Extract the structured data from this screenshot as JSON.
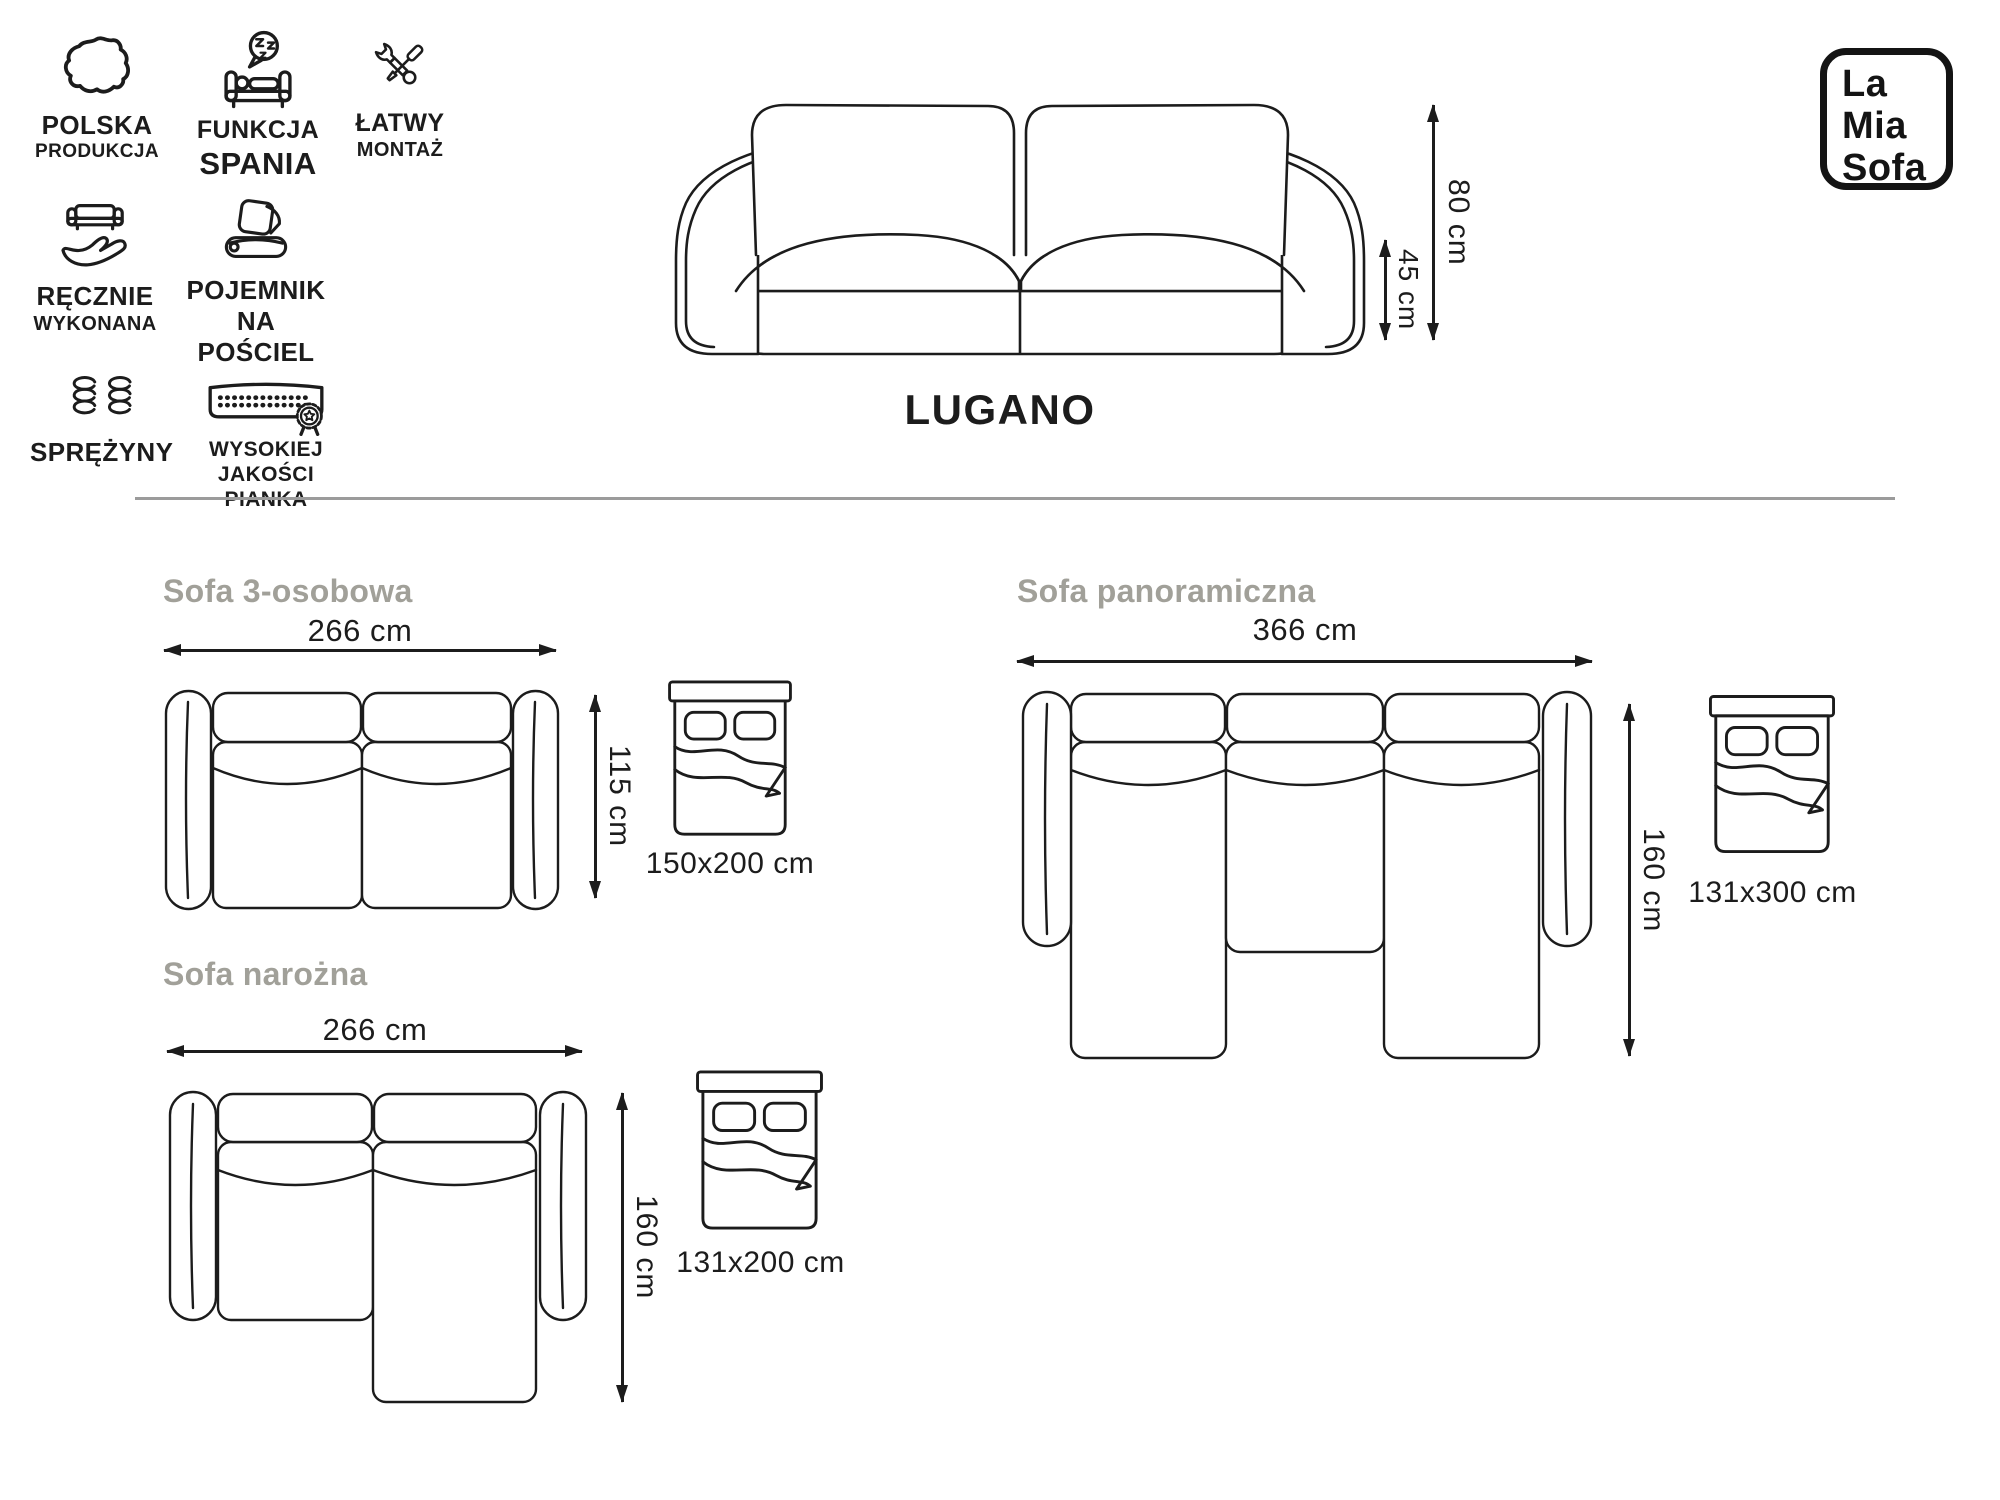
{
  "brand": {
    "line1": "La",
    "line2": "Mia",
    "line3": "Sofa"
  },
  "product": {
    "name": "LUGANO",
    "total_height": "80 cm",
    "seat_height": "45 cm"
  },
  "features": [
    {
      "icon": "poland-map-icon",
      "line1": "POLSKA",
      "line2": "PRODUKCJA"
    },
    {
      "icon": "sleep-function-icon",
      "line1": "FUNKCJA",
      "line2": "SPANIA"
    },
    {
      "icon": "easy-assembly-icon",
      "line1": "ŁATWY",
      "line2": "MONTAŻ"
    },
    {
      "icon": "handmade-icon",
      "line1": "RĘCZNIE",
      "line2": "WYKONANA"
    },
    {
      "icon": "bedding-storage-icon",
      "line1": "POJEMNIK",
      "line2": "NA POŚCIEL"
    },
    {
      "icon": "springs-icon",
      "line1": "SPRĘŻYNY",
      "line2": ""
    },
    {
      "icon": "high-quality-foam-icon",
      "line1": "WYSOKIEJ",
      "line2": "JAKOŚCI PIANKA"
    }
  ],
  "variants": [
    {
      "name": "Sofa 3-osobowa",
      "width": "266 cm",
      "depth": "115 cm",
      "sleeping_area": "150x200 cm"
    },
    {
      "name": "Sofa panoramiczna",
      "width": "366 cm",
      "depth": "160 cm",
      "sleeping_area": "131x300 cm"
    },
    {
      "name": "Sofa narożna",
      "width": "266 cm",
      "depth": "160 cm",
      "sleeping_area": "131x200 cm"
    }
  ],
  "colors": {
    "line": "#1c1c1c",
    "heading": "#a1a099",
    "divider": "#9b9b9b",
    "text": "#1c1c1c"
  }
}
